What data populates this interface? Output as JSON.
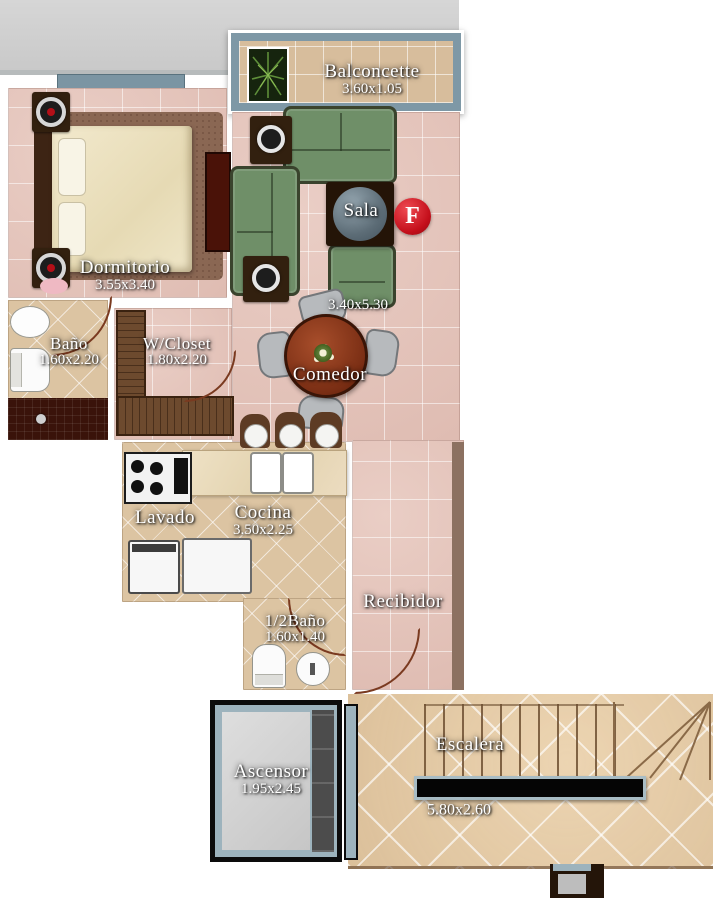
{
  "plan": {
    "marker": {
      "label": "F"
    },
    "rooms": {
      "balconcette": {
        "name": "Balconcette",
        "dims": "3.60x1.05"
      },
      "dormitorio": {
        "name": "Dormitorio",
        "dims": "3.55x3.40"
      },
      "sala": {
        "name": "Sala",
        "dims": "3.40x5.30"
      },
      "bano": {
        "name": "Baño",
        "dims": "1.60x2.20"
      },
      "wcloset": {
        "name": "W/Closet",
        "dims": "1.80x2.20"
      },
      "comedor": {
        "name": "Comedor"
      },
      "lavado": {
        "name": "Lavado"
      },
      "cocina": {
        "name": "Cocina",
        "dims": "3.50x2.25"
      },
      "recibidor": {
        "name": "Recibidor"
      },
      "half_bano": {
        "name": "1/2Baño",
        "dims": "1.60x1.40"
      },
      "ascensor": {
        "name": "Ascensor",
        "dims": "1.95x2.45"
      },
      "escalera": {
        "name": "Escalera",
        "dims": "5.80x2.60"
      }
    },
    "colors": {
      "floor_pink": "#e6c5bb",
      "floor_beige": "#dcc4a2",
      "hall_beige": "#e4cba8",
      "sofa_green": "#6f8f68",
      "dining_table": "#9c4526",
      "marker_red": "#d21420",
      "balcony_blue": "#7e98a6",
      "wood_brown": "#6d4a2e",
      "shower_brown": "#3a130a",
      "exterior_gray": "#d0d0d0",
      "railing_trim": "#a8bcc4"
    }
  }
}
